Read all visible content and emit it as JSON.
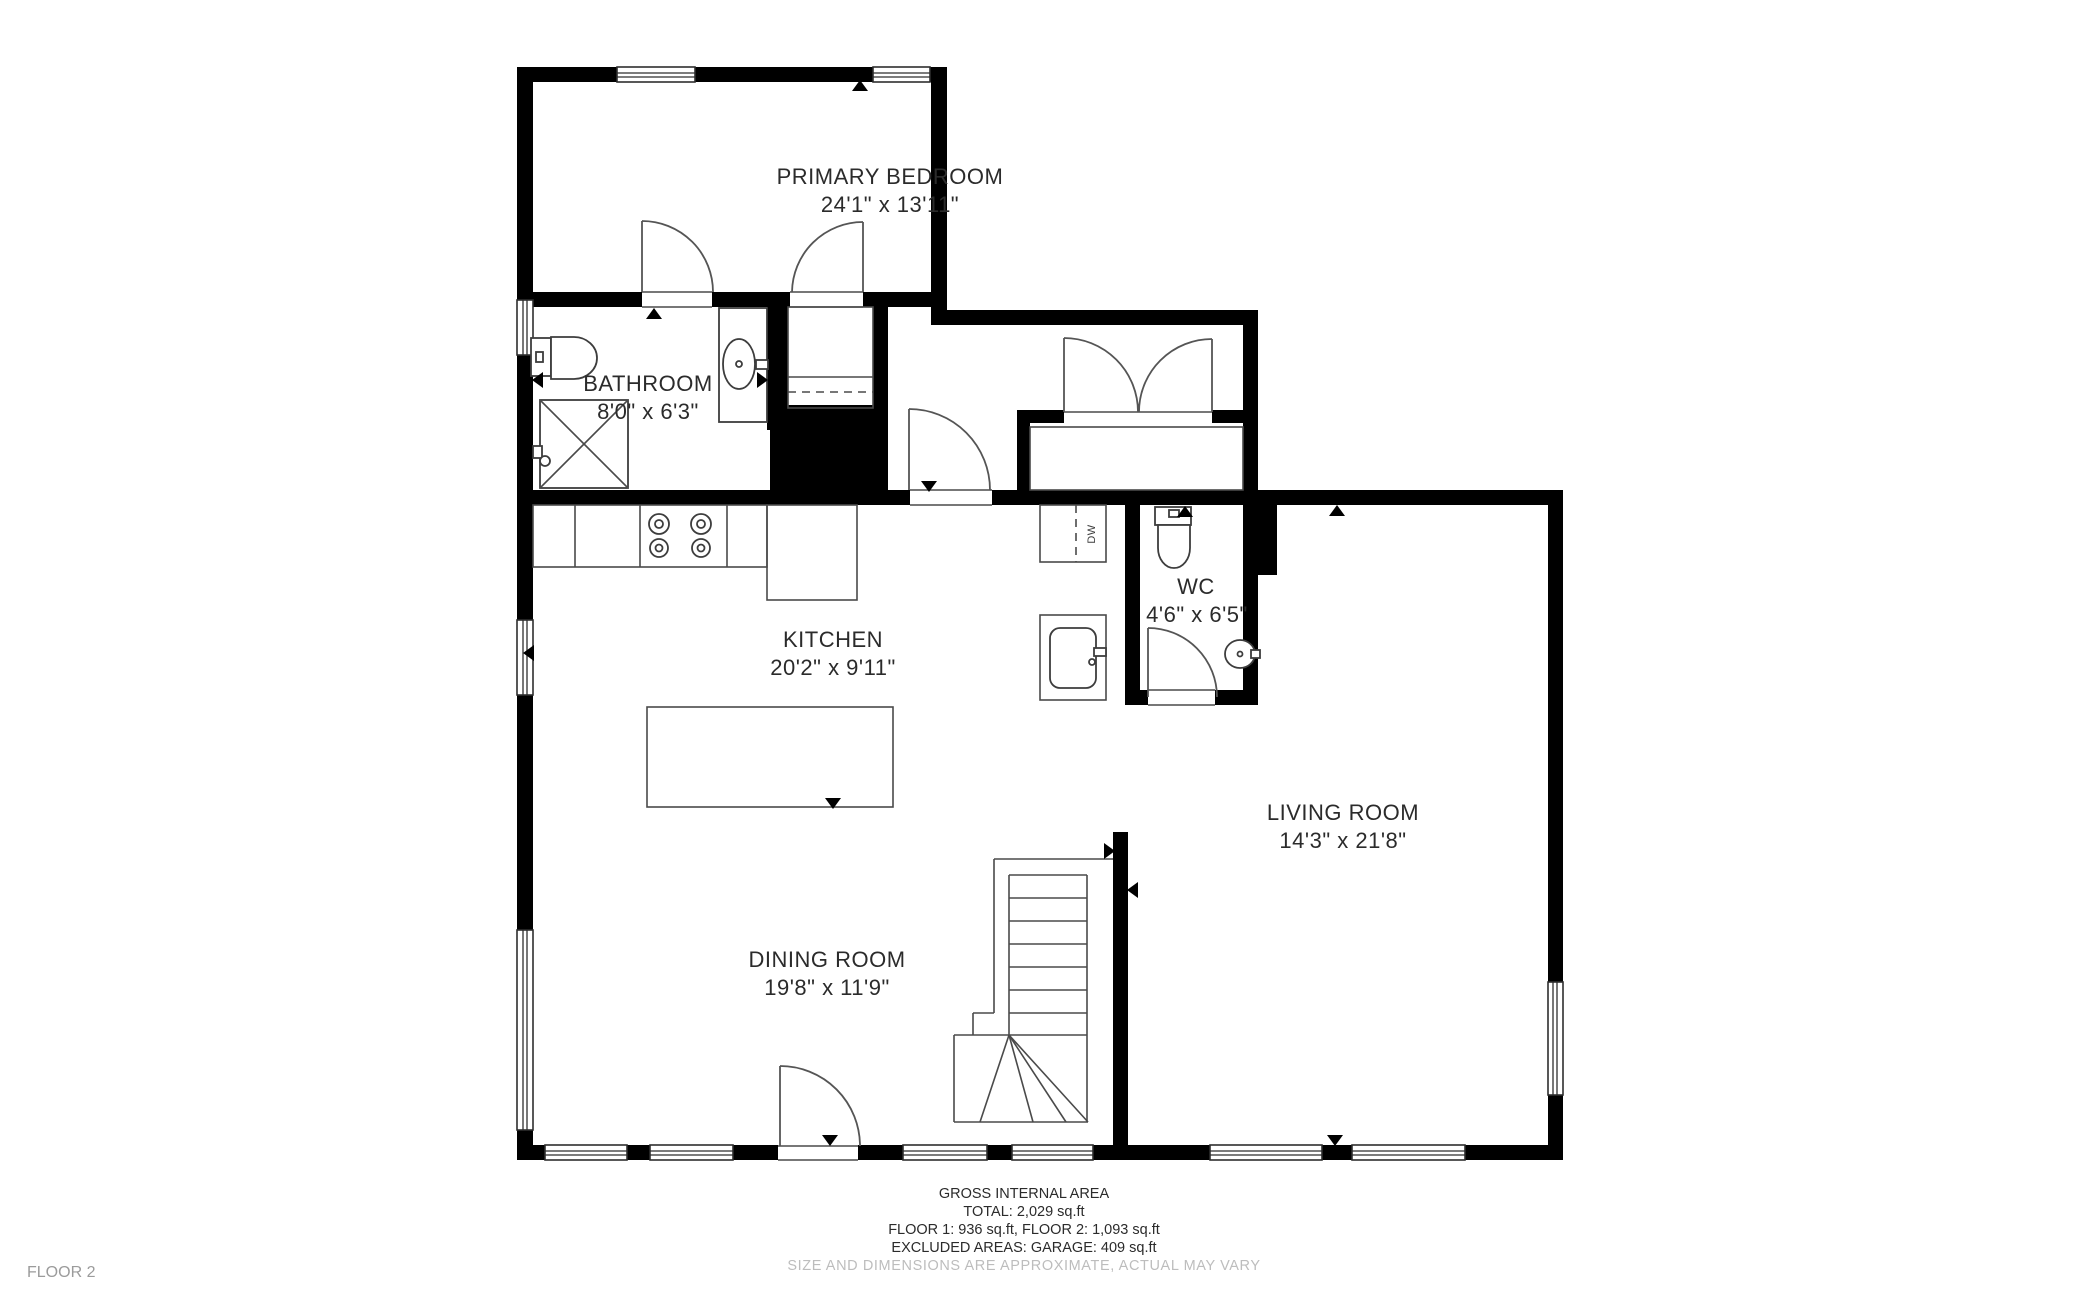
{
  "floor_label": "FLOOR 2",
  "rooms": [
    {
      "id": "primary-bedroom",
      "name": "PRIMARY BEDROOM",
      "dims": "24'1\" x 13'11\""
    },
    {
      "id": "bathroom",
      "name": "BATHROOM",
      "dims": "8'0\" x 6'3\""
    },
    {
      "id": "kitchen",
      "name": "KITCHEN",
      "dims": "20'2\" x 9'11\""
    },
    {
      "id": "wc",
      "name": "WC",
      "dims": "4'6\" x 6'5\""
    },
    {
      "id": "living-room",
      "name": "LIVING ROOM",
      "dims": "14'3\" x 21'8\""
    },
    {
      "id": "dining-room",
      "name": "DINING ROOM",
      "dims": "19'8\" x 11'9\""
    }
  ],
  "appliances": {
    "dishwasher": "DW"
  },
  "footer": {
    "title": "GROSS INTERNAL AREA",
    "total": "TOTAL: 2,029 sq.ft",
    "floors": "FLOOR 1: 936 sq.ft, FLOOR 2: 1,093 sq.ft",
    "excluded": "EXCLUDED AREAS: GARAGE: 409 sq.ft",
    "disclaimer": "SIZE AND DIMENSIONS ARE APPROXIMATE, ACTUAL MAY VARY"
  },
  "colors": {
    "walls": "#000000",
    "lines": "#3d3d3d",
    "text": "#2b2b2b",
    "muted": "#bdbdbd",
    "background": "#ffffff"
  }
}
